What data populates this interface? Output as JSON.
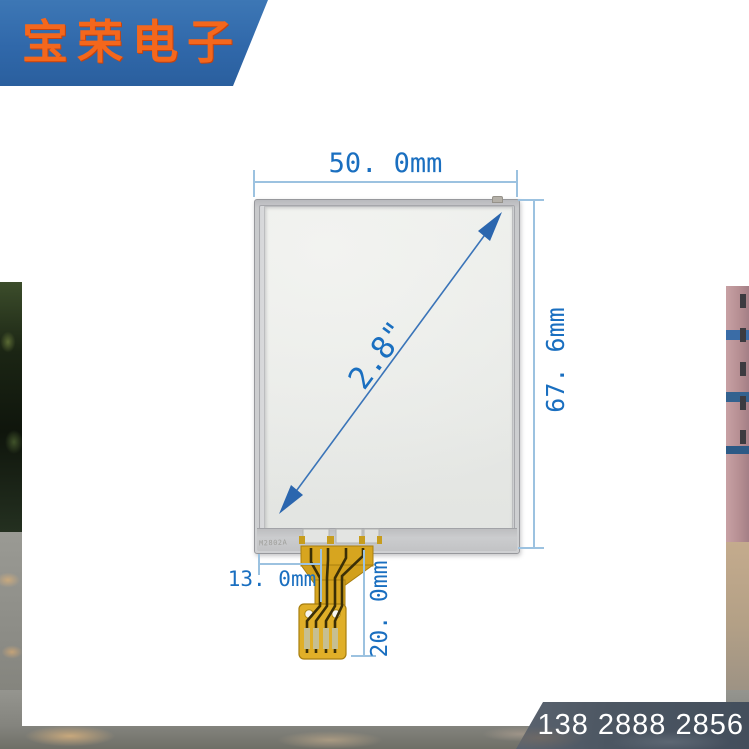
{
  "brand": {
    "name": "宝荣电子",
    "banner_color": "#3068aa",
    "logo_color": "#f4671c"
  },
  "contact": {
    "phone": "138 2888 2856"
  },
  "product": {
    "type_icon": "touch-panel",
    "marking": "M2802A"
  },
  "annotations": {
    "width": "50. 0mm",
    "height": "67. 6mm",
    "diagonal": "2.8\"",
    "fpc_offset": "13. 0mm",
    "fpc_length": "20. 0mm"
  },
  "colors": {
    "dimension_text": "#1a6fc0",
    "dimension_line": "#9cc2e0",
    "arrow_blue": "#2b66ae",
    "fpc_yellow": "#d7a51f",
    "panel_glass": "#e9ebe8",
    "phone_banner": "#4c5662"
  }
}
